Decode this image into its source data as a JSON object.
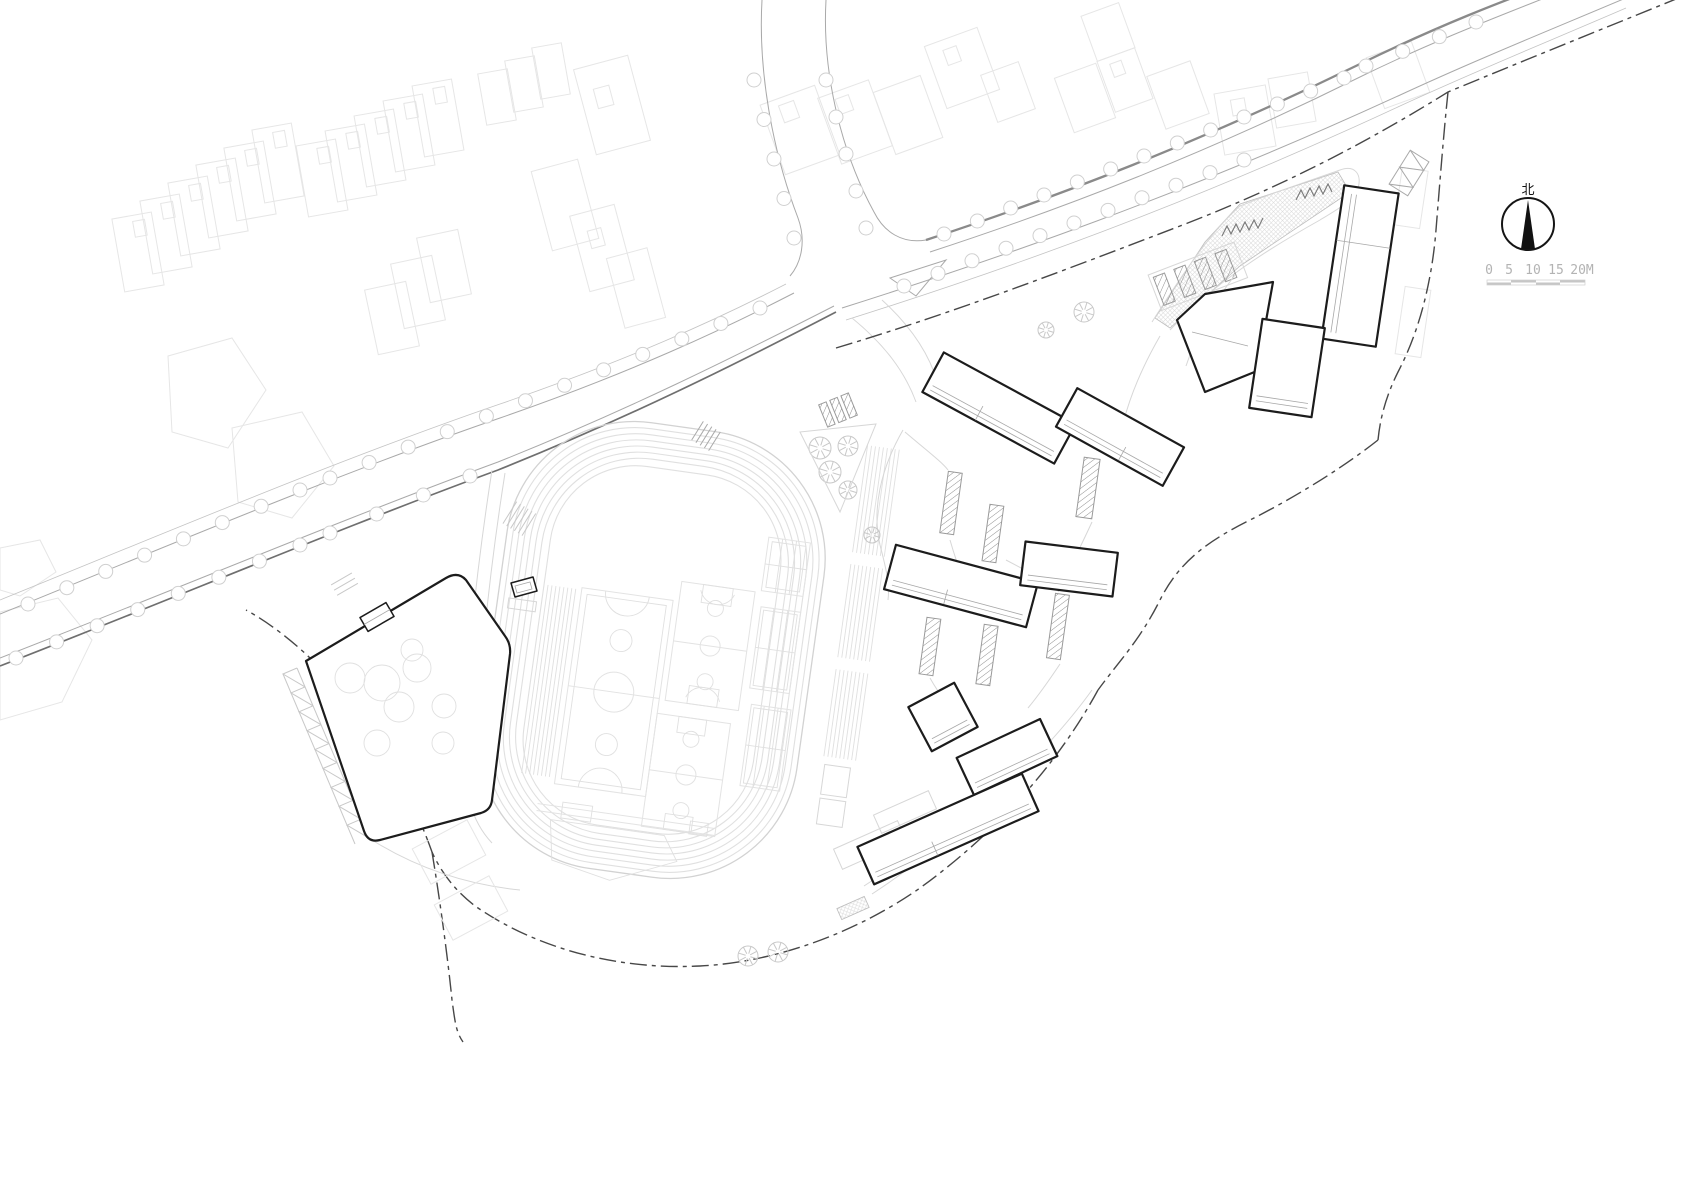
{
  "page": {
    "background": "#ffffff",
    "kind_label": "site plan drawing"
  },
  "north_arrow": {
    "label": "北"
  },
  "scale_bar": {
    "ticks": [
      "0",
      "5",
      "10",
      "15",
      "20M"
    ]
  },
  "palette": {
    "ink": "#1c1c1c",
    "context_gray": "#e6e6e6",
    "road_gray": "#a9a9a9",
    "road_dark": "#6f6f6f",
    "track_gray": "#e0e0e0",
    "tree_gray": "#d0d0d0",
    "boundary_gray": "#474747",
    "hatch_gray": "#9a9a9a",
    "label_gray": "#b3b3b3"
  }
}
